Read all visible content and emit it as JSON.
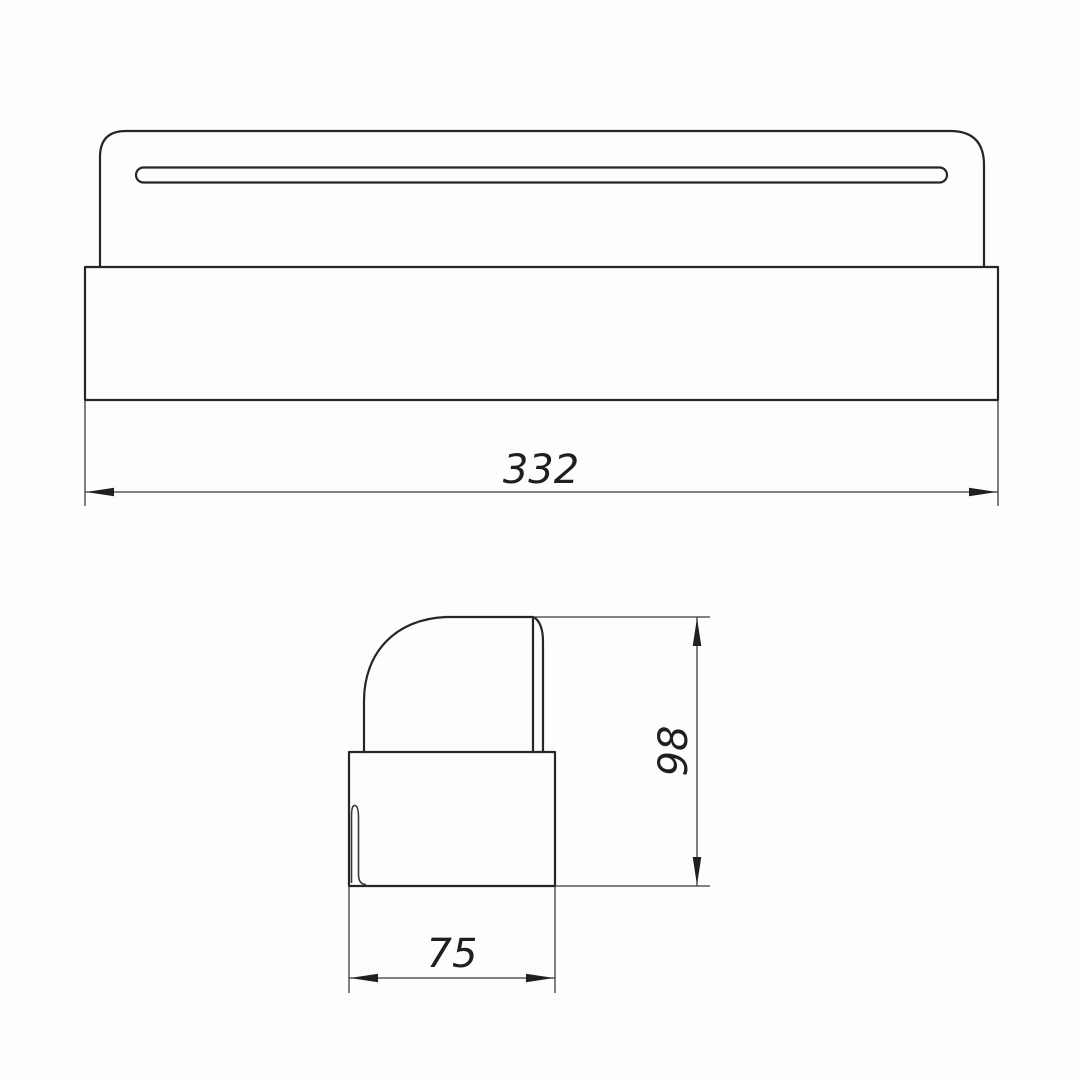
{
  "meta": {
    "type": "engineering-drawing",
    "background": "#fdfdfd",
    "line_color": "#262626",
    "dim_color": "#1f1f1f"
  },
  "views": {
    "front": {
      "name": "front view",
      "features": [
        "rounded top plate",
        "long mounting slot",
        "wide base block"
      ]
    },
    "side": {
      "name": "side profile view",
      "features": [
        "rounded cap profile",
        "back plate edge",
        "base block",
        "inner seam line"
      ]
    }
  },
  "dimensions": {
    "overall_width": {
      "value": "332",
      "orientation": "horizontal",
      "view": "front"
    },
    "overall_height": {
      "value": "98",
      "orientation": "vertical",
      "view": "side"
    },
    "overall_depth": {
      "value": "75",
      "orientation": "horizontal",
      "view": "side"
    }
  }
}
